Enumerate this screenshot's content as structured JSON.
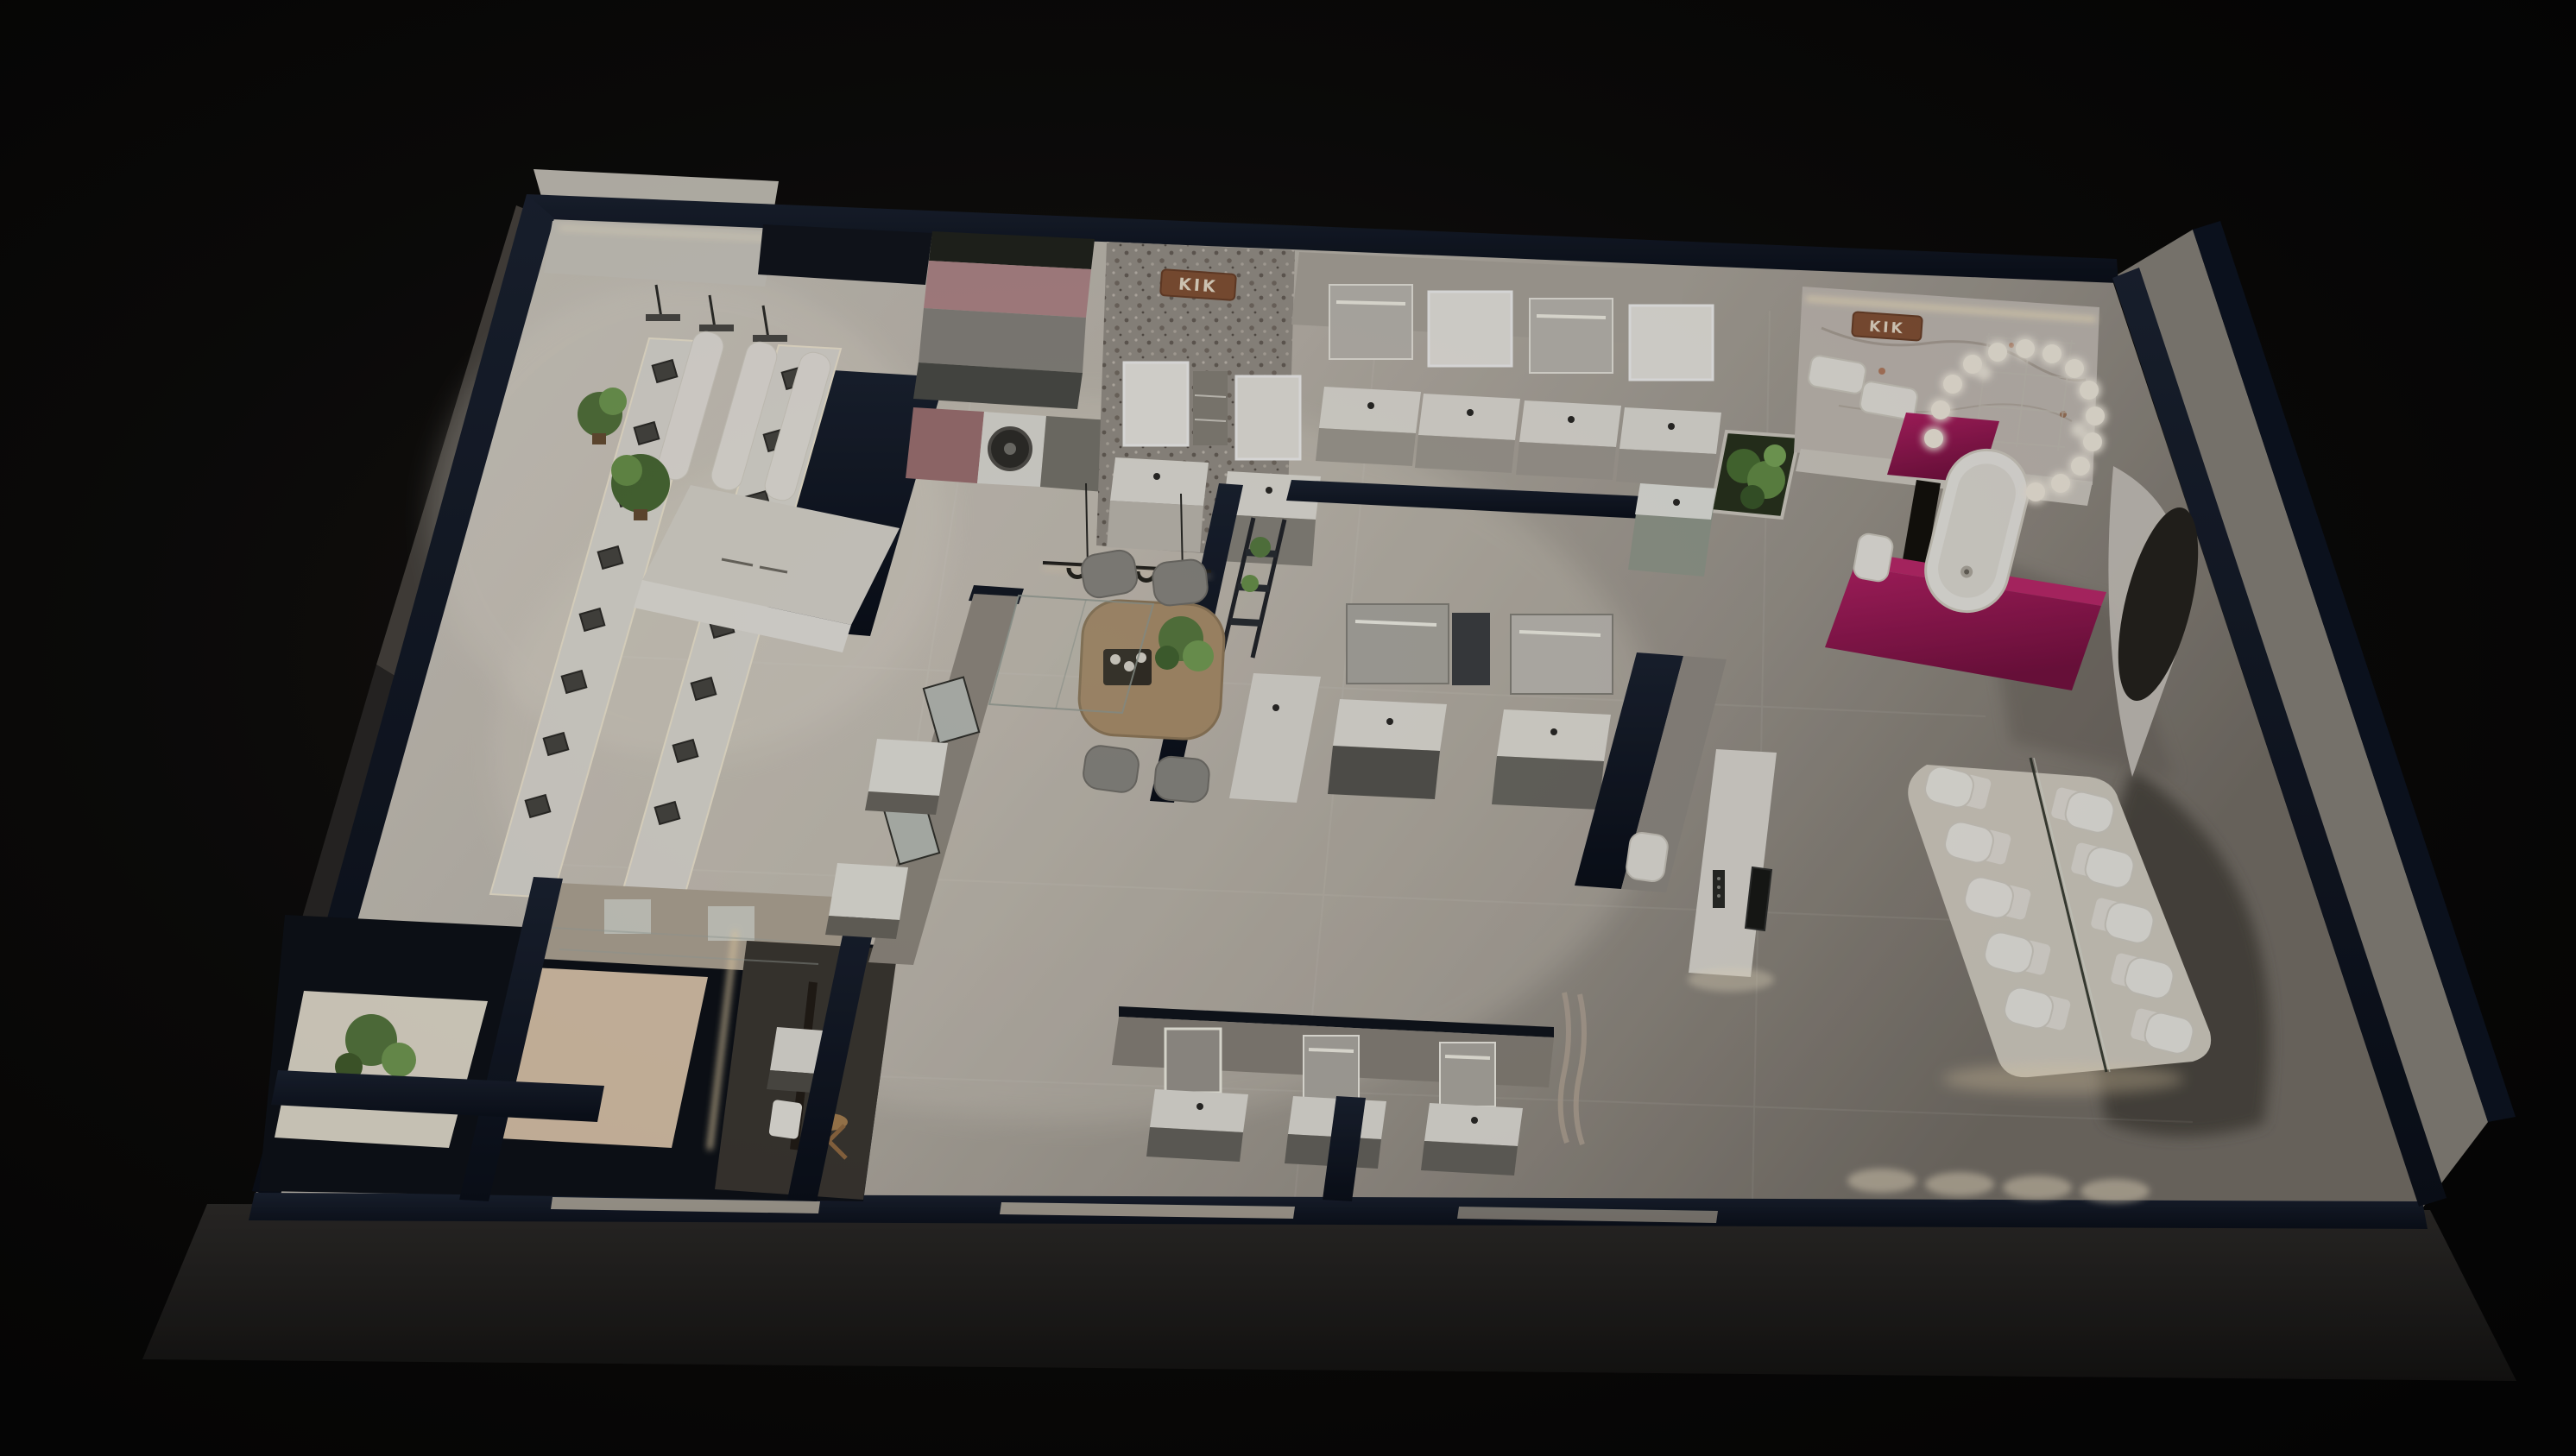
{
  "scene": {
    "type": "3d-isometric-architectural-render",
    "setting": "bathroom sanitary-ware showroom, night dollhouse top view",
    "brand": "KIK"
  },
  "signs": [
    {
      "text": "KIK",
      "material": "copper",
      "location": "terrazzo feature wall"
    },
    {
      "text": "KIK",
      "material": "copper",
      "location": "marble feature wall"
    }
  ],
  "palette": {
    "background": "#070606",
    "outer_wall_navy": "#0d1420",
    "floor_light": "#d8d3c9",
    "floor_dark": "#7e7870",
    "accent_magenta": "#a61b5e",
    "accent_pink_wall": "#bb8f91",
    "wood": "#b49873",
    "plant_green": "#5d8144",
    "led_warm": "#ffedc2",
    "copper_sign": "#8a5638",
    "white_fixture": "#f4f2ec"
  },
  "inventory": {
    "shower_display_sets": 16,
    "ceiling_shower_displays": 3,
    "mirror_vanity_stations": 13,
    "toilets_on_platform": 10,
    "freestanding_bathtub": 1,
    "washing_machine": 1,
    "dining_chairs": 4,
    "chandelier_ball_lights": 16,
    "plants": 9,
    "tv_display": 1
  },
  "zones": [
    {
      "id": "shower-gallery",
      "label": "shower fittings display gallery"
    },
    {
      "id": "laundry-nook",
      "label": "laundry counter with washing machine"
    },
    {
      "id": "terrazzo-wall",
      "label": "terrazzo feature wall with brand sign"
    },
    {
      "id": "vanity-row-north",
      "label": "north vanity stations with lit mirrors"
    },
    {
      "id": "central-lounge",
      "label": "meeting table with pendant light"
    },
    {
      "id": "planter-garden",
      "label": "indoor planter beds"
    },
    {
      "id": "bathtub-suite",
      "label": "magenta bathtub suite with ball chandelier"
    },
    {
      "id": "toilet-platform",
      "label": "lit toilet display platform with glass divider"
    },
    {
      "id": "media-console",
      "label": "white media console with TV"
    },
    {
      "id": "vanity-row-south",
      "label": "south vanity stations"
    },
    {
      "id": "private-bath-rooms",
      "label": "navy-walled bath compartments"
    },
    {
      "id": "vanity-island",
      "label": "double-sided vanity display island"
    }
  ]
}
